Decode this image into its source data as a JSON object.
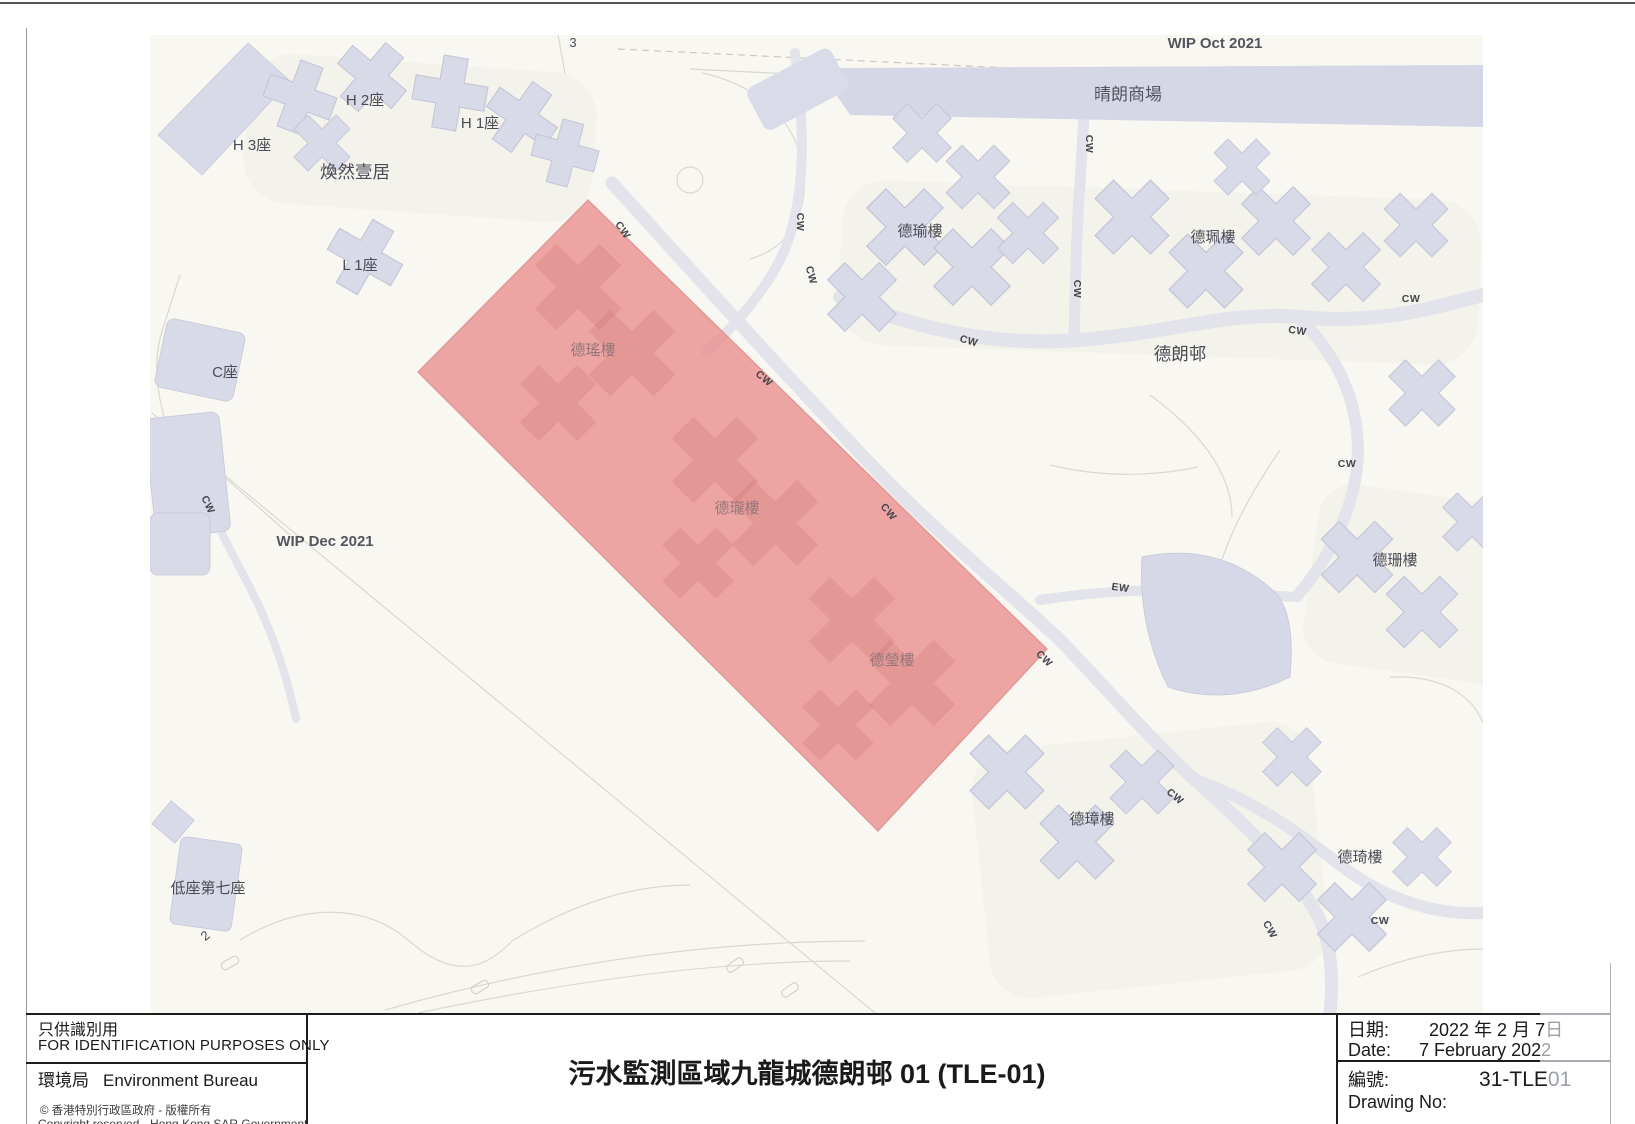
{
  "titleblock": {
    "for_identification_zh": "只供識別用",
    "for_identification_en": "FOR IDENTIFICATION PURPOSES ONLY",
    "bureau_zh": "環境局",
    "bureau_en": "Environment Bureau",
    "copyright_zh": "© 香港特別行政區政府 - 版權所有",
    "copyright_en": "Copyright reserved - Hong Kong SAR Government",
    "title": "污水監測區域九龍城德朗邨 01 (TLE-01)",
    "date_label_zh": "日期:",
    "date_value_zh_main": "2022 年 2 月 7",
    "date_value_zh_overflow": "日",
    "date_label_en": "Date:",
    "date_value_en_main": "7 February 202",
    "date_value_en_overflow": "2",
    "drawing_label_zh": "編號:",
    "drawing_value_main": "31-TLE",
    "drawing_value_overflow": "01",
    "drawing_label_en": "Drawing No:"
  },
  "map": {
    "labels": {
      "wip_oct": "WIP Oct 2021",
      "wip_dec": "WIP Dec 2021",
      "mall": "晴朗商場",
      "hk_estate": "煥然壹居",
      "h1": "H 1座",
      "h2": "H 2座",
      "h3": "H 3座",
      "l1": "L 1座",
      "c": "C座",
      "low7": "低座第七座",
      "tak_long": "德朗邨",
      "tak_yu": "德瑜樓",
      "tak_pui": "德珮樓",
      "tak_shan": "德珊樓",
      "tak_yiu": "德瑤樓",
      "tak_lung": "德瓏樓",
      "tak_ying": "德瑩樓",
      "tak_cheung": "德璋樓",
      "tak_kei": "德琦樓",
      "cw": "CW",
      "ew": "EW",
      "num3": "3",
      "num2": "2"
    },
    "appearance": {
      "surveillance_area_fill": "#E8908E",
      "building_fill": "#D8DAE8",
      "mall_fill": "#D5D7E6",
      "map_background": "#F8F7F1"
    }
  }
}
